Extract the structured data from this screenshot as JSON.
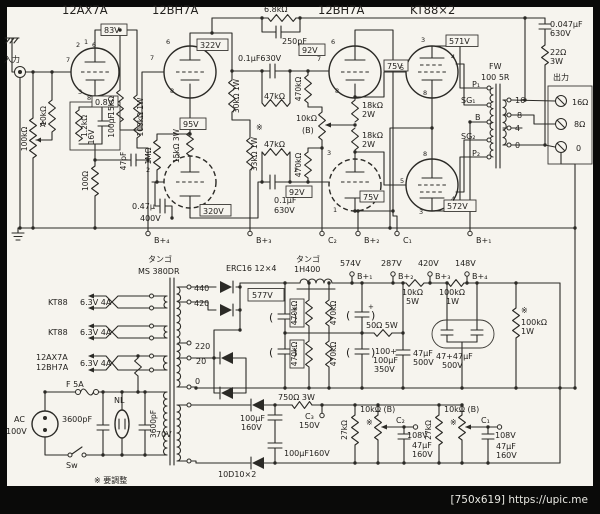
{
  "image": {
    "type": "scanned tube-amplifier schematic",
    "paper_color": "#f6f4ee",
    "ink_color": "#2b2a26",
    "frame_color": "#0a0a09",
    "watermark": "[750x619] https://upic.me"
  },
  "labels": {
    "t12ax7a": "12AX7A",
    "t12bh7a": "12BH7A",
    "tkt88": "KT88×2",
    "nyuryoku": "入力",
    "shutsuryoku": "出力",
    "fbR": "6.8kΩ",
    "fbC": "250pF",
    "volR": "100kΩ",
    "volA": "A",
    "gridR": "10kΩ",
    "v83": "83V",
    "v08": "0.8V",
    "rk": "1.2kΩ",
    "ck": "100µF",
    "ckv": "16V",
    "r100": "100Ω",
    "c47p": "47pF",
    "r15k": "15kΩ",
    "r100k1w": "100kΩ 1W",
    "v322": "322V",
    "v95": "95V",
    "v320": "320V",
    "c047": "0.47µ",
    "v400": "400V",
    "r1m": "1MΩ",
    "r15k3w": "15kΩ 3W",
    "r30k": "30kΩ 1W",
    "r33k": "33kΩ 1W",
    "cc1": "0.1µF630V",
    "cc2a": "0.1µF",
    "v630": "630V",
    "r47k": "47kΩ",
    "adj": "※",
    "v92": "92V",
    "r470k": "470kΩ",
    "bal": "10kΩ",
    "balB": "(B)",
    "r18k": "18kΩ",
    "w2": "2W",
    "v75": "75V",
    "v571": "571V",
    "v572": "572V",
    "fw": "FW",
    "fw2": "100 5R",
    "p1": "P₁",
    "sg1": "SG₁",
    "bTap": "B",
    "sg2": "SG₂",
    "p2": "P₂",
    "s16": "16",
    "s8": "8",
    "s4": "4",
    "s0": "0",
    "o16": "16Ω",
    "o8": "8Ω",
    "zc": "0.047µF",
    "zr": "22Ω",
    "w3": "3W",
    "bB4": "B+₄",
    "bB3": "B+₃",
    "bC2": "C₂",
    "bB2": "B+₂",
    "bC1": "C₁",
    "bB1": "B+₁",
    "tango": "タンゴ",
    "ptModel": "MS 380DR",
    "tp440": "440",
    "tp420": "420",
    "tp220": "220",
    "tp20": "20",
    "rectifier": "ERC16 12×4",
    "choke": "1H400",
    "v577": "577V",
    "v574": "574V",
    "v287": "287V",
    "v420": "420V",
    "v148": "148V",
    "w5": "5W",
    "r100kL": "100kΩ",
    "w1": "1W",
    "r50": "50Ω 5W",
    "cb1": "100+",
    "cb3": "350V",
    "c47u": "47µF",
    "v500": "500V",
    "can": "47+47µF",
    "parL": "(",
    "parR": ")",
    "plus": "+",
    "hKT88": "KT88",
    "h63": "6.3V 4A",
    "fuse": "F 5A",
    "ac": "AC",
    "ac100": "100V",
    "spark": "3600pF",
    "nl": "NL",
    "sw": "Sw",
    "note": "※ 要調整",
    "v70": "70V",
    "d10": "10D10×2",
    "r750": "750Ω 3W",
    "v160": "160V",
    "cbias": "100µF160V",
    "c3": "C₃",
    "v150": "150V",
    "r27k": "27kΩ",
    "potB": "10kΩ (B)",
    "v108": "108V"
  },
  "pins": [
    "2",
    "1",
    "6",
    "7",
    "3",
    "8",
    "6",
    "7",
    "8",
    "3",
    "2",
    "6",
    "7",
    "8",
    "3",
    "2",
    "1",
    "3",
    "4",
    "5",
    "8",
    "8",
    "5",
    "3",
    "4"
  ]
}
